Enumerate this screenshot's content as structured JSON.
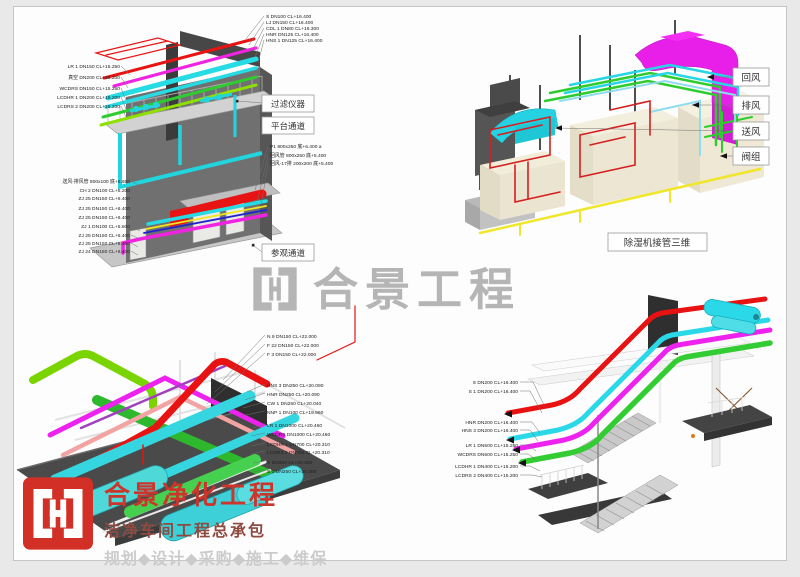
{
  "watermark": {
    "text": "合景工程"
  },
  "brand": {
    "title": "合景净化工程",
    "subtitle": "洁净车间工程总承包",
    "tagline": "规划◆设计◆采购◆施工◆维保"
  },
  "colors": {
    "brand_red": "#ca352c",
    "watermark_gray": "#b5b5b5",
    "pipe_red": "#e81414",
    "pipe_magenta": "#ee22ee",
    "pipe_cyan": "#27dbe4",
    "pipe_green": "#2ecc2e",
    "pipe_yellow": "#f2e71d",
    "duct_magenta": "#e81fe8",
    "duct_cyan": "#25d2e2"
  },
  "panel_top_left": {
    "top_labels": [
      "S DN100 CL+16.400",
      "LJ DN150 CL+16.400",
      "CDL 1 DN80 CL+16.300",
      "HNR DN125 CL+16.400",
      "HNS 1 DN125 CL+16.400"
    ],
    "left_labels": [
      "LR 1 DN150 CL+15.250",
      "真空 DN200 CL+15.200",
      "WCDRS DN150 CL+15.250",
      "LCDHR 1 DN200 CL+15.200",
      "LCDRS 2 DN200 CL+15.200"
    ],
    "mid_labels": [
      "P1 800x250 底+6.400 a",
      "回风管 800x250 底+5.400",
      "回风-17排 200x200 底+5.400"
    ],
    "bottom_labels": [
      "送风-排风管 800x100 底+6.650",
      "CH 2 DN100 CL+5.200",
      "ZJ 25 DN150 CL+6.400",
      "ZJ 25 DN150 CL+6.400",
      "ZJ 25 DN150 CL+6.400",
      "ZJ 1 DN100 CL+5.600",
      "ZJ 25 DN150 CL+6.400",
      "ZJ 25 DN150 CL+6.400",
      "ZJ 24 DN150 CL+6.400"
    ],
    "boxes": [
      "过滤仪器",
      "平台通道",
      "参观通道"
    ]
  },
  "panel_top_right": {
    "boxes": [
      "回风",
      "排风",
      "送风",
      "阀组"
    ],
    "caption": "除湿机接管三维"
  },
  "panel_bottom_left": {
    "group1": [
      "N 9 DN150 CL+22.000",
      "F 22 DN150 CL+22.000",
      "F 3 DN150 CL+22.000"
    ],
    "group2": [
      "HNS 3 DN250 CL+20.090",
      "HNR DN250 CL+20.090",
      "CW 1 DN250 CL+20.040",
      "NNP 1 DN100 CL+19.960"
    ],
    "group3": [
      "LR 1 DN1000 CL+20.460",
      "WCDRS DN1000 CL+20.460",
      "LCDHR 1 DN700 CL+20.310",
      "LCDRS 2 DN700 CL+20.310",
      "S DN350 CL+20.300",
      "S 1 DN250 CL+20.300"
    ]
  },
  "panel_bottom_right": {
    "labels": [
      "S DN200 CL+16.400",
      "S 1 DN200 CL+16.400",
      "HNR DN200 CL+16.400",
      "HNS 3 DN200 CL+16.400",
      "LR 1 DN500 CL+15.250",
      "WCDRS DN500 CL+15.250",
      "LCDHR 1 DN400 CL+15.200",
      "LCDRS 2 DN400 CL+15.200"
    ]
  }
}
